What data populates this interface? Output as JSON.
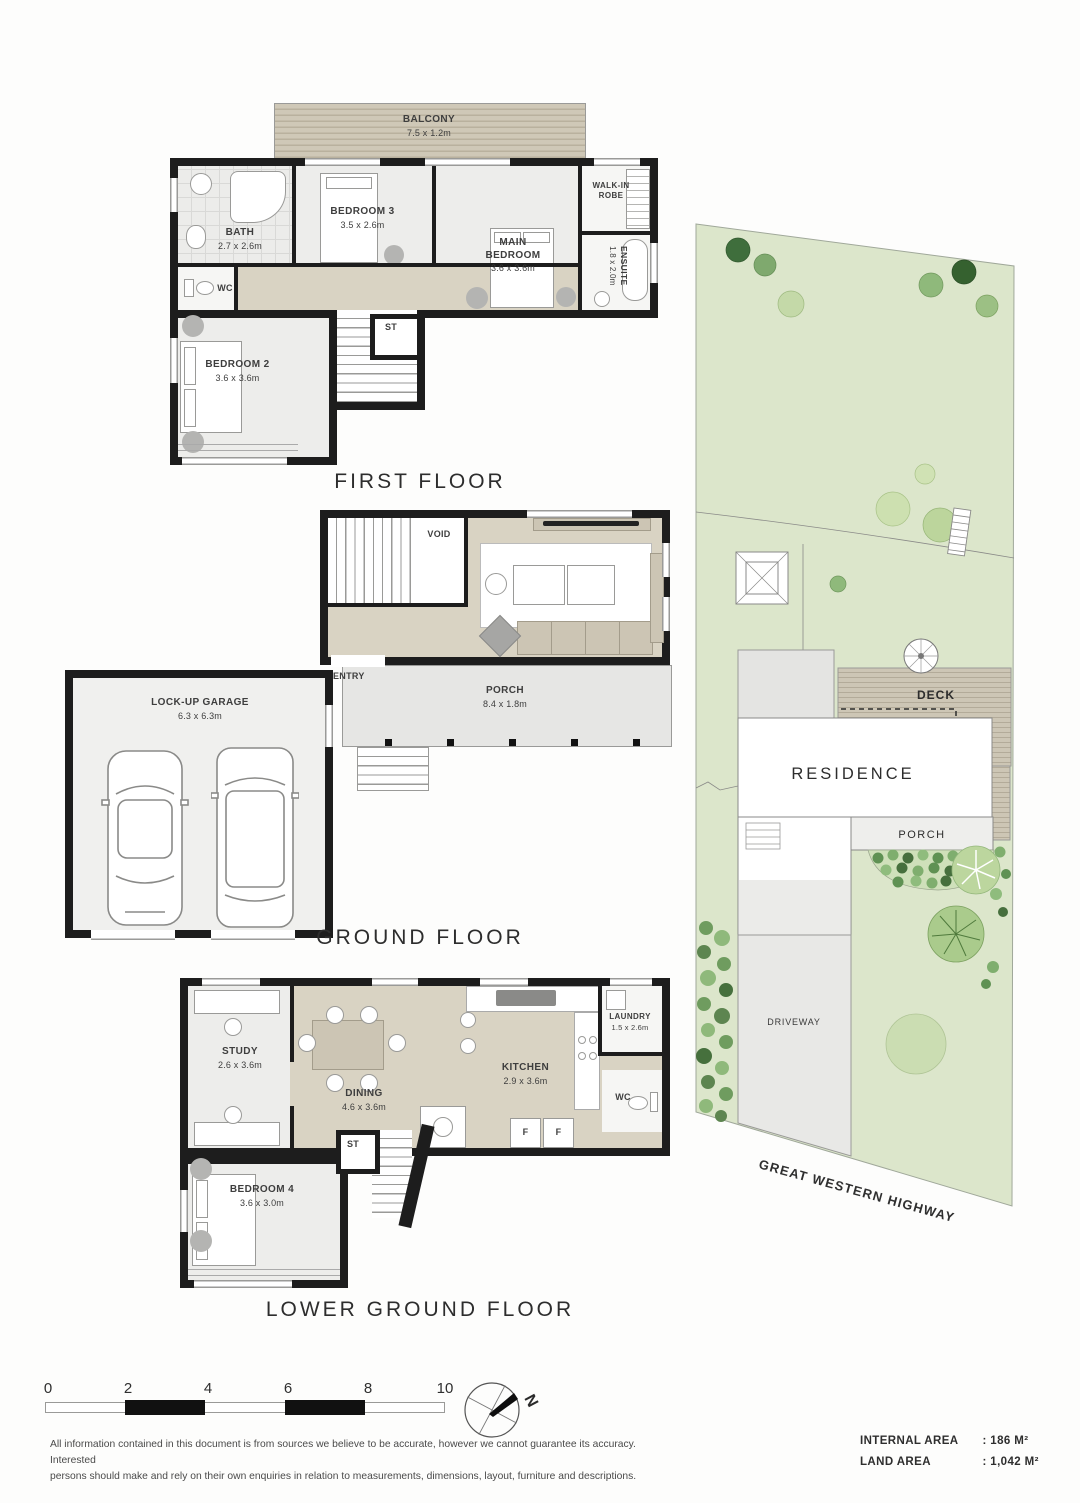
{
  "floors": {
    "first": {
      "label": "FIRST FLOOR",
      "balcony": {
        "name": "BALCONY",
        "dims": "7.5 x 1.2m"
      },
      "bath": {
        "name": "BATH",
        "dims": "2.7 x 2.6m"
      },
      "bedroom3": {
        "name": "BEDROOM 3",
        "dims": "3.5 x 2.6m"
      },
      "main_bedroom": {
        "name": "MAIN BEDROOM",
        "dims": "3.6 x 3.6m"
      },
      "walk_in_robe": {
        "name": "WALK-IN ROBE"
      },
      "ensuite": {
        "name": "ENSUITE",
        "dims": "1.8 x 2.0m"
      },
      "wc": {
        "name": "WC"
      },
      "st": {
        "name": "ST"
      },
      "bedroom2": {
        "name": "BEDROOM 2",
        "dims": "3.6 x 3.6m"
      }
    },
    "ground": {
      "label": "GROUND FLOOR",
      "void": {
        "name": "VOID"
      },
      "living": {
        "name": "LIVING",
        "dims": "6.3 x 3.6m"
      },
      "entry": {
        "name": "ENTRY"
      },
      "porch": {
        "name": "PORCH",
        "dims": "8.4 x 1.8m"
      },
      "garage": {
        "name": "LOCK-UP GARAGE",
        "dims": "6.3 x 6.3m"
      }
    },
    "lower": {
      "label": "LOWER GROUND FLOOR",
      "study": {
        "name": "STUDY",
        "dims": "2.6 x 3.6m"
      },
      "dining": {
        "name": "DINING",
        "dims": "4.6 x 3.6m"
      },
      "kitchen": {
        "name": "KITCHEN",
        "dims": "2.9 x 3.6m"
      },
      "laundry": {
        "name": "LAUNDRY",
        "dims": "1.5 x 2.6m"
      },
      "wc": {
        "name": "WC"
      },
      "st": {
        "name": "ST"
      },
      "bedroom4": {
        "name": "BEDROOM 4",
        "dims": "3.6 x 3.0m"
      },
      "f1": "F",
      "f2": "F"
    }
  },
  "site": {
    "residence": "RESIDENCE",
    "deck": "DECK",
    "porch": "PORCH",
    "driveway": "DRIVEWAY",
    "highway": "GREAT WESTERN HIGHWAY"
  },
  "scale_bar": {
    "ticks": [
      "0",
      "2",
      "4",
      "6",
      "8",
      "10"
    ]
  },
  "compass": {
    "north": "N"
  },
  "disclaimer": {
    "line1": "All information contained in this document is from sources we believe to be accurate, however we cannot guarantee its accuracy. Interested",
    "line2": "persons should make and rely on their own enquiries in relation to measurements, dimensions, layout, furniture and descriptions."
  },
  "areas": {
    "rows": [
      {
        "label": "INTERNAL AREA",
        "value": ": 186 M²"
      },
      {
        "label": "LAND AREA",
        "value": ": 1,042 M²"
      }
    ]
  }
}
